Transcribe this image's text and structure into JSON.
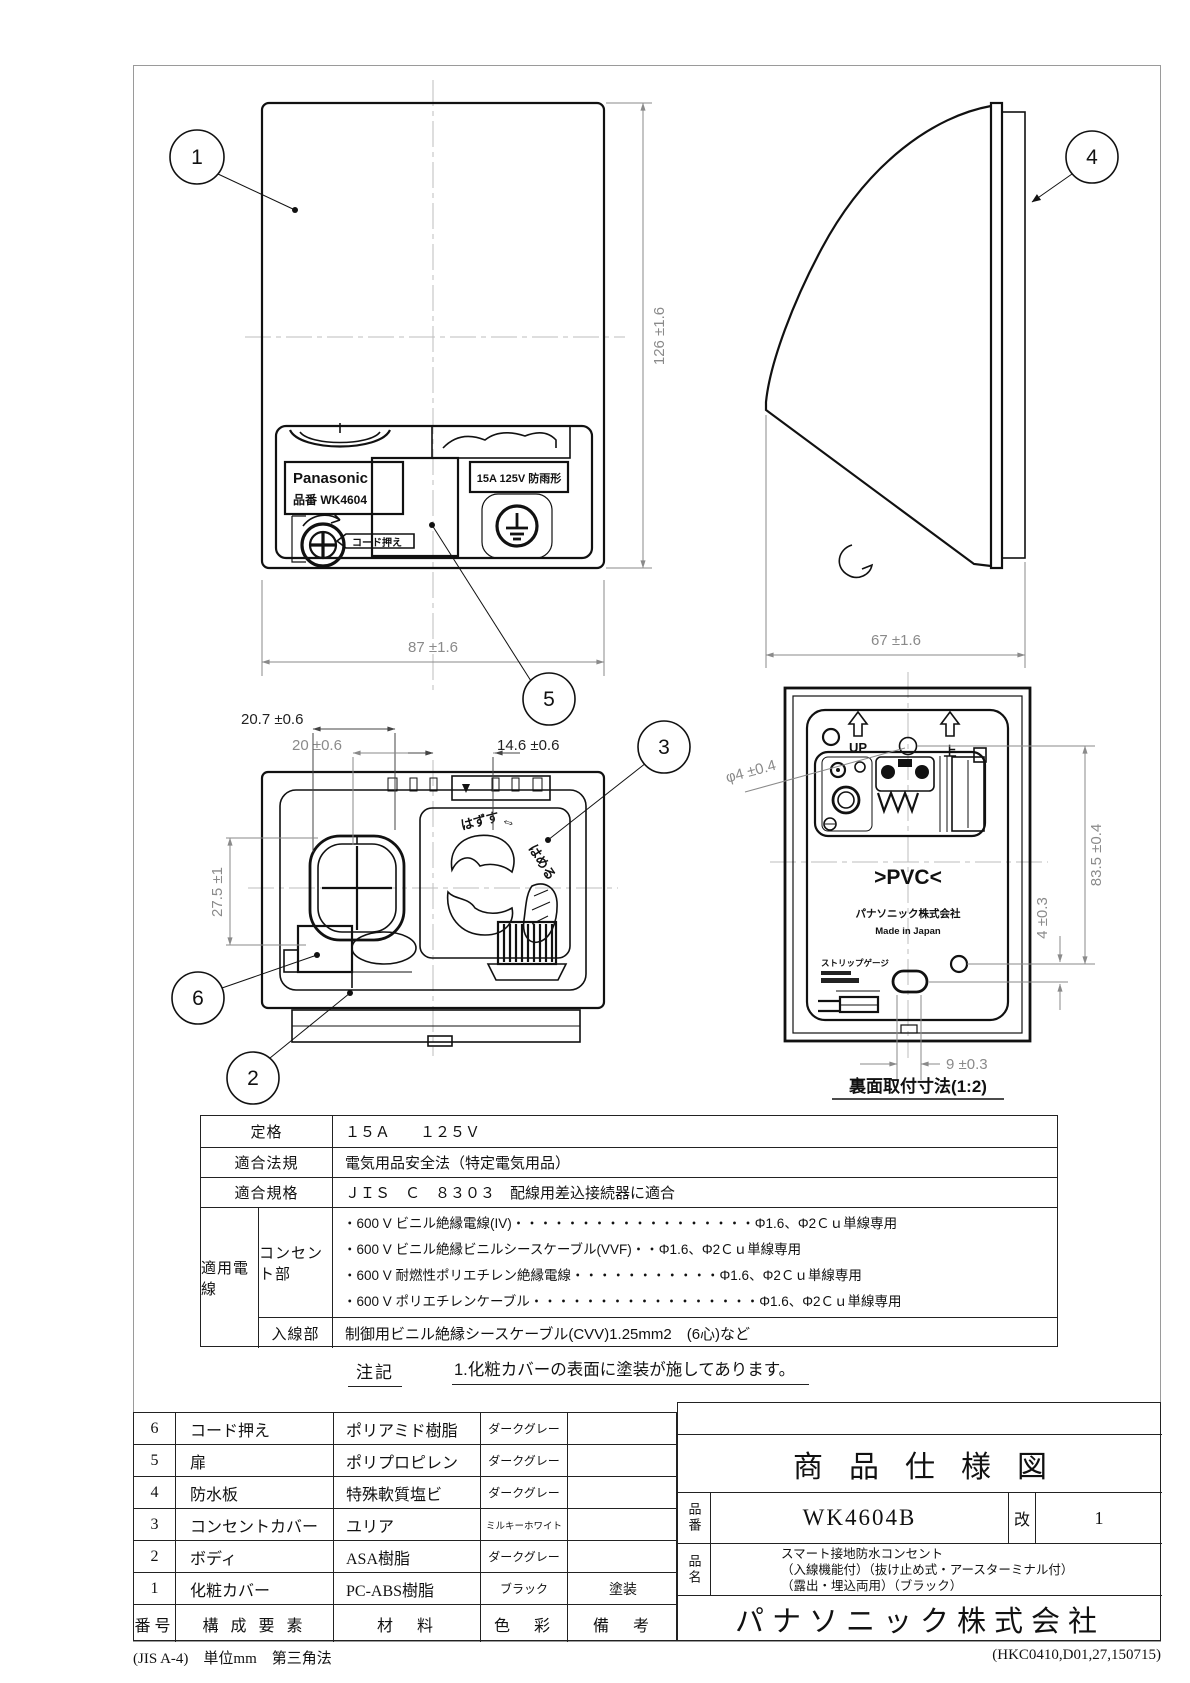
{
  "drawing": {
    "balloons": {
      "b1": "1",
      "b2": "2",
      "b3": "3",
      "b4": "4",
      "b5": "5",
      "b6": "6"
    },
    "front": {
      "brand": "Panasonic",
      "model": "品番 WK4604",
      "rating": "15A 125V 防雨形",
      "cord_tag": "コード押え",
      "dim_h": "126 ±1.6",
      "dim_w": "87 ±1.6"
    },
    "side": {
      "dim_d": "67 ±1.6"
    },
    "open": {
      "dim_a": "20.7 ±0.6",
      "dim_b": "20 ±0.6",
      "dim_c": "14.6 ±0.6",
      "dim_e": "27.5 ±1",
      "txt_remove": "はずす",
      "txt_arrow": "⇔",
      "txt_attach": "はめる"
    },
    "back": {
      "dim_hole": "φ4 ±0.4",
      "dim_v1": "83.5 ±0.4",
      "dim_v2": "4 ±0.3",
      "dim_w9": "9 ±0.3",
      "up_en": "UP",
      "up_ja": "上",
      "pvc": ">PVC<",
      "maker": "パナソニック株式会社",
      "made": "Made in Japan",
      "strip": "ストリップゲージ",
      "caption": "裏面取付寸法(1:2)"
    }
  },
  "spec_table": {
    "rows": [
      {
        "label": "定格",
        "value": "１５Ａ　　１２５Ｖ"
      },
      {
        "label": "適合法規",
        "value": "電気用品安全法（特定電気用品）"
      },
      {
        "label": "適合規格",
        "value": "ＪＩＳ　Ｃ　８３０３　配線用差込接続器に適合"
      }
    ],
    "wire_label": "適用電線",
    "outlet_label": "コンセント部",
    "outlet_lines": [
      "・600 V ビニル絶縁電線(IV)・・・・・・・・・・・・・・・・・・Φ1.6、Φ2Ｃｕ単線専用",
      "・600 V ビニル絶縁ビニルシースケーブル(VVF)・・Φ1.6、Φ2Ｃｕ単線専用",
      "・600 V 耐燃性ポリエチレン絶縁電線・・・・・・・・・・・Φ1.6、Φ2Ｃｕ単線専用",
      "・600 V ポリエチレンケーブル・・・・・・・・・・・・・・・・・Φ1.6、Φ2Ｃｕ単線専用"
    ],
    "inlet_label": "入線部",
    "inlet_value": "制御用ビニル絶縁シースケーブル(CVV)1.25mm2　(6心)など"
  },
  "notes": {
    "label": "注記",
    "text": "1.化粧カバーの表面に塗装が施してあります。"
  },
  "parts_table": {
    "headers": [
      "番号",
      "構 成 要 素",
      "材　料",
      "色　彩",
      "備　考"
    ],
    "rows": [
      [
        "6",
        "コード押え",
        "ポリアミド樹脂",
        "ダークグレー",
        ""
      ],
      [
        "5",
        "扉",
        "ポリプロピレン",
        "ダークグレー",
        ""
      ],
      [
        "4",
        "防水板",
        "特殊軟質塩ビ",
        "ダークグレー",
        ""
      ],
      [
        "3",
        "コンセントカバー",
        "ユリア",
        "ミルキーホワイト",
        ""
      ],
      [
        "2",
        "ボディ",
        "ASA樹脂",
        "ダークグレー",
        ""
      ],
      [
        "1",
        "化粧カバー",
        "PC-ABS樹脂",
        "ブラック",
        "塗装"
      ]
    ]
  },
  "title_block": {
    "title": "商品仕様図",
    "part_no_label": "品番",
    "part_no": "WK4604B",
    "rev_label": "改",
    "rev": "1",
    "name_label": "品名",
    "name_lines": [
      "スマート接地防水コンセント",
      "（入線機能付）（抜け止め式・アースターミナル付）",
      "（露出・埋込両用）（ブラック）"
    ],
    "company": "パナソニック株式会社"
  },
  "footer": {
    "left": "(JIS A-4)　単位mm　第三角法",
    "right": "(HKC0410,D01,27,150715)"
  }
}
